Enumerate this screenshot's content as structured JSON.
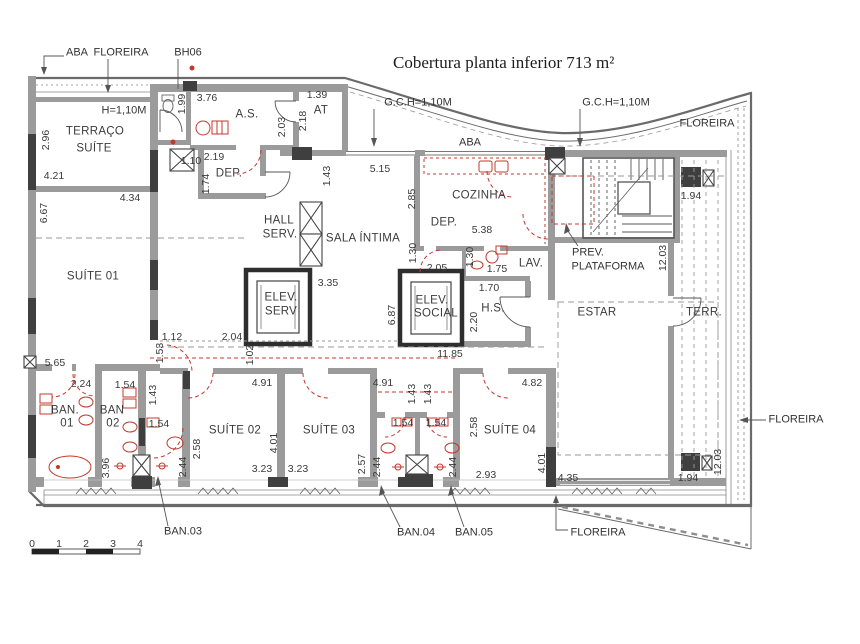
{
  "title": {
    "text": "Cobertura planta inferior  713 m²"
  },
  "colors": {
    "red_accent": "#c0392b",
    "wall_gray": "#9b9b9b",
    "dark_fill": "#3f3f3f",
    "text": "#3a3a3a"
  },
  "legend": {
    "drawing_type": "floor-plan"
  },
  "labels": [
    {
      "n": "callout-aba-topleft",
      "t": "ABA",
      "x": 77,
      "y": 53,
      "k": "call"
    },
    {
      "n": "callout-floreira-topleft",
      "t": "FLOREIRA",
      "x": 121,
      "y": 53,
      "k": "call"
    },
    {
      "n": "callout-bh06",
      "t": "BH06",
      "x": 188,
      "y": 53,
      "k": "call"
    },
    {
      "n": "callout-gch-left",
      "t": "G.C.H=1,10M",
      "x": 418,
      "y": 103,
      "k": "call"
    },
    {
      "n": "callout-gch-right",
      "t": "G.C.H=1,10M",
      "x": 616,
      "y": 103,
      "k": "call"
    },
    {
      "n": "callout-floreira-topright",
      "t": "FLOREIRA",
      "x": 707,
      "y": 124,
      "k": "call"
    },
    {
      "n": "callout-aba-mid",
      "t": "ABA",
      "x": 470,
      "y": 143,
      "k": "call"
    },
    {
      "n": "callout-floreira-right",
      "t": "FLOREIRA",
      "x": 796,
      "y": 420,
      "k": "call"
    },
    {
      "n": "callout-floreira-bottom",
      "t": "FLOREIRA",
      "x": 598,
      "y": 533,
      "k": "call"
    },
    {
      "n": "callout-ban03",
      "t": "BAN.03",
      "x": 183,
      "y": 532,
      "k": "call"
    },
    {
      "n": "callout-ban04",
      "t": "BAN.04",
      "x": 416,
      "y": 533,
      "k": "call"
    },
    {
      "n": "callout-ban05",
      "t": "BAN.05",
      "x": 474,
      "y": 533,
      "k": "call"
    },
    {
      "n": "callout-prev",
      "t": "PREV.",
      "x": 588,
      "y": 253,
      "k": "call"
    },
    {
      "n": "callout-plataforma",
      "t": "PLATAFORMA",
      "x": 608,
      "y": 267,
      "k": "call"
    },
    {
      "n": "callout-h110",
      "t": "H=1,10M",
      "x": 124,
      "y": 111,
      "k": "call"
    },
    {
      "n": "room-terraco",
      "t": "TERRAÇO",
      "x": 95,
      "y": 132,
      "k": "room"
    },
    {
      "n": "room-terraco-suite",
      "t": "SUÍTE",
      "x": 94,
      "y": 149,
      "k": "room"
    },
    {
      "n": "room-as",
      "t": "A.S.",
      "x": 247,
      "y": 115,
      "k": "room"
    },
    {
      "n": "room-at",
      "t": "AT",
      "x": 321,
      "y": 111,
      "k": "room"
    },
    {
      "n": "room-dep1",
      "t": "DEP.",
      "x": 229,
      "y": 174,
      "k": "room"
    },
    {
      "n": "room-hall",
      "t": "HALL",
      "x": 279,
      "y": 221,
      "k": "room"
    },
    {
      "n": "room-hall-serv",
      "t": "SERV.",
      "x": 280,
      "y": 235,
      "k": "room"
    },
    {
      "n": "room-sala-intima",
      "t": "SALA ÍNTIMA",
      "x": 363,
      "y": 239,
      "k": "room"
    },
    {
      "n": "room-elev-serv1",
      "t": "ELEV.",
      "x": 281,
      "y": 298,
      "k": "room"
    },
    {
      "n": "room-elev-serv2",
      "t": "SERV",
      "x": 281,
      "y": 312,
      "k": "room"
    },
    {
      "n": "room-cozinha",
      "t": "COZINHA",
      "x": 479,
      "y": 196,
      "k": "room"
    },
    {
      "n": "room-dep2",
      "t": "DEP.",
      "x": 444,
      "y": 223,
      "k": "room"
    },
    {
      "n": "room-lav",
      "t": "LAV.",
      "x": 531,
      "y": 264,
      "k": "room"
    },
    {
      "n": "room-elev-social1",
      "t": "ELEV.",
      "x": 432,
      "y": 301,
      "k": "room"
    },
    {
      "n": "room-elev-social2",
      "t": "SOCIAL",
      "x": 436,
      "y": 314,
      "k": "room"
    },
    {
      "n": "room-hs",
      "t": "H.S.",
      "x": 493,
      "y": 309,
      "k": "room"
    },
    {
      "n": "room-estar",
      "t": "ESTAR",
      "x": 597,
      "y": 313,
      "k": "room"
    },
    {
      "n": "room-terr",
      "t": "TERR.",
      "x": 704,
      "y": 313,
      "k": "room"
    },
    {
      "n": "room-suite01",
      "t": "SUÍTE 01",
      "x": 93,
      "y": 277,
      "k": "room"
    },
    {
      "n": "room-suite02",
      "t": "SUÍTE 02",
      "x": 235,
      "y": 431,
      "k": "room"
    },
    {
      "n": "room-suite03",
      "t": "SUÍTE 03",
      "x": 329,
      "y": 431,
      "k": "room"
    },
    {
      "n": "room-suite04",
      "t": "SUÍTE 04",
      "x": 510,
      "y": 431,
      "k": "room"
    },
    {
      "n": "room-ban01a",
      "t": "BAN.",
      "x": 65,
      "y": 411,
      "k": "room"
    },
    {
      "n": "room-ban01b",
      "t": "01",
      "x": 67,
      "y": 424,
      "k": "room"
    },
    {
      "n": "room-ban02a",
      "t": "BAN",
      "x": 112,
      "y": 411,
      "k": "room"
    },
    {
      "n": "room-ban02b",
      "t": "02",
      "x": 113,
      "y": 424,
      "k": "room"
    },
    {
      "n": "dim-421",
      "t": "4.21",
      "x": 54,
      "y": 176
    },
    {
      "n": "dim-434",
      "t": "4.34",
      "x": 130,
      "y": 198
    },
    {
      "n": "dim-110",
      "t": "1.10",
      "x": 191,
      "y": 161
    },
    {
      "n": "dim-376",
      "t": "3.76",
      "x": 207,
      "y": 98
    },
    {
      "n": "dim-139",
      "t": "1.39",
      "x": 317,
      "y": 95
    },
    {
      "n": "dim-219",
      "t": "2.19",
      "x": 214,
      "y": 157
    },
    {
      "n": "dim-515",
      "t": "5.15",
      "x": 380,
      "y": 169
    },
    {
      "n": "dim-538",
      "t": "5.38",
      "x": 482,
      "y": 230
    },
    {
      "n": "dim-205",
      "t": "2.05",
      "x": 437,
      "y": 268
    },
    {
      "n": "dim-175",
      "t": "1.75",
      "x": 497,
      "y": 269
    },
    {
      "n": "dim-170",
      "t": "1.70",
      "x": 489,
      "y": 288
    },
    {
      "n": "dim-335",
      "t": "3.35",
      "x": 328,
      "y": 283
    },
    {
      "n": "dim-112",
      "t": "1.12",
      "x": 172,
      "y": 337
    },
    {
      "n": "dim-204",
      "t": "2.04",
      "x": 232,
      "y": 337
    },
    {
      "n": "dim-565",
      "t": "5.65",
      "x": 55,
      "y": 363
    },
    {
      "n": "dim-224",
      "t": "2.24",
      "x": 81,
      "y": 384
    },
    {
      "n": "dim-154a",
      "t": "1.54",
      "x": 125,
      "y": 385
    },
    {
      "n": "dim-1185",
      "t": "11.85",
      "x": 450,
      "y": 354
    },
    {
      "n": "dim-491a",
      "t": "4.91",
      "x": 262,
      "y": 383
    },
    {
      "n": "dim-491b",
      "t": "4.91",
      "x": 383,
      "y": 383
    },
    {
      "n": "dim-482",
      "t": "4.82",
      "x": 532,
      "y": 383
    },
    {
      "n": "dim-154b",
      "t": "1.54",
      "x": 159,
      "y": 424
    },
    {
      "n": "dim-154c",
      "t": "1.54",
      "x": 403,
      "y": 423
    },
    {
      "n": "dim-154d",
      "t": "1.54",
      "x": 436,
      "y": 423
    },
    {
      "n": "dim-323a",
      "t": "3.23",
      "x": 262,
      "y": 469
    },
    {
      "n": "dim-323b",
      "t": "3.23",
      "x": 298,
      "y": 469
    },
    {
      "n": "dim-293",
      "t": "2.93",
      "x": 486,
      "y": 475
    },
    {
      "n": "dim-435",
      "t": "4.35",
      "x": 568,
      "y": 478
    },
    {
      "n": "dim-194a",
      "t": "1.94",
      "x": 691,
      "y": 196
    },
    {
      "n": "dim-194b",
      "t": "1.94",
      "x": 688,
      "y": 478
    },
    {
      "n": "dim-296",
      "t": "2.96",
      "x": 46,
      "y": 140,
      "r": 1
    },
    {
      "n": "dim-667",
      "t": "6.67",
      "x": 44,
      "y": 213,
      "r": 1
    },
    {
      "n": "dim-199",
      "t": "1.99",
      "x": 182,
      "y": 104,
      "r": 1
    },
    {
      "n": "dim-203",
      "t": "2.03",
      "x": 282,
      "y": 127,
      "r": 1
    },
    {
      "n": "dim-218",
      "t": "2.18",
      "x": 303,
      "y": 121,
      "r": 1
    },
    {
      "n": "dim-174",
      "t": "1.74",
      "x": 206,
      "y": 184,
      "r": 1
    },
    {
      "n": "dim-143a",
      "t": "1.43",
      "x": 327,
      "y": 176,
      "r": 1
    },
    {
      "n": "dim-285",
      "t": "2.85",
      "x": 412,
      "y": 199,
      "r": 1
    },
    {
      "n": "dim-130a",
      "t": "1.30",
      "x": 413,
      "y": 253,
      "r": 1
    },
    {
      "n": "dim-130b",
      "t": "1.30",
      "x": 470,
      "y": 257,
      "r": 1
    },
    {
      "n": "dim-220",
      "t": "2.20",
      "x": 474,
      "y": 322,
      "r": 1
    },
    {
      "n": "dim-687",
      "t": "6.87",
      "x": 392,
      "y": 315,
      "r": 1
    },
    {
      "n": "dim-102",
      "t": "1.02",
      "x": 250,
      "y": 355,
      "r": 1
    },
    {
      "n": "dim-153",
      "t": "1.53",
      "x": 160,
      "y": 353,
      "r": 1
    },
    {
      "n": "dim-143b",
      "t": "1.43",
      "x": 153,
      "y": 395,
      "r": 1
    },
    {
      "n": "dim-143c",
      "t": "1.43",
      "x": 412,
      "y": 394,
      "r": 1
    },
    {
      "n": "dim-143d",
      "t": "1.43",
      "x": 428,
      "y": 394,
      "r": 1
    },
    {
      "n": "dim-258a",
      "t": "2.58",
      "x": 197,
      "y": 449,
      "r": 1
    },
    {
      "n": "dim-244a",
      "t": "2.44",
      "x": 183,
      "y": 467,
      "r": 1
    },
    {
      "n": "dim-396",
      "t": "3.96",
      "x": 106,
      "y": 468,
      "r": 1
    },
    {
      "n": "dim-401a",
      "t": "4.01",
      "x": 274,
      "y": 443,
      "r": 1
    },
    {
      "n": "dim-257",
      "t": "2.57",
      "x": 362,
      "y": 464,
      "r": 1
    },
    {
      "n": "dim-244b",
      "t": "2.44",
      "x": 377,
      "y": 467,
      "r": 1
    },
    {
      "n": "dim-244c",
      "t": "2.44",
      "x": 453,
      "y": 467,
      "r": 1
    },
    {
      "n": "dim-258b",
      "t": "2.58",
      "x": 474,
      "y": 427,
      "r": 1
    },
    {
      "n": "dim-401b",
      "t": "4.01",
      "x": 542,
      "y": 463,
      "r": 1
    },
    {
      "n": "dim-1203a",
      "t": "12.03",
      "x": 663,
      "y": 258,
      "r": 1
    },
    {
      "n": "dim-1203b",
      "t": "12.03",
      "x": 718,
      "y": 462,
      "r": 1
    },
    {
      "n": "scale-0",
      "t": "0",
      "x": 32,
      "y": 544
    },
    {
      "n": "scale-1",
      "t": "1",
      "x": 59,
      "y": 544
    },
    {
      "n": "scale-2",
      "t": "2",
      "x": 86,
      "y": 544
    },
    {
      "n": "scale-3",
      "t": "3",
      "x": 113,
      "y": 544
    },
    {
      "n": "scale-4",
      "t": "4",
      "x": 140,
      "y": 544
    }
  ]
}
